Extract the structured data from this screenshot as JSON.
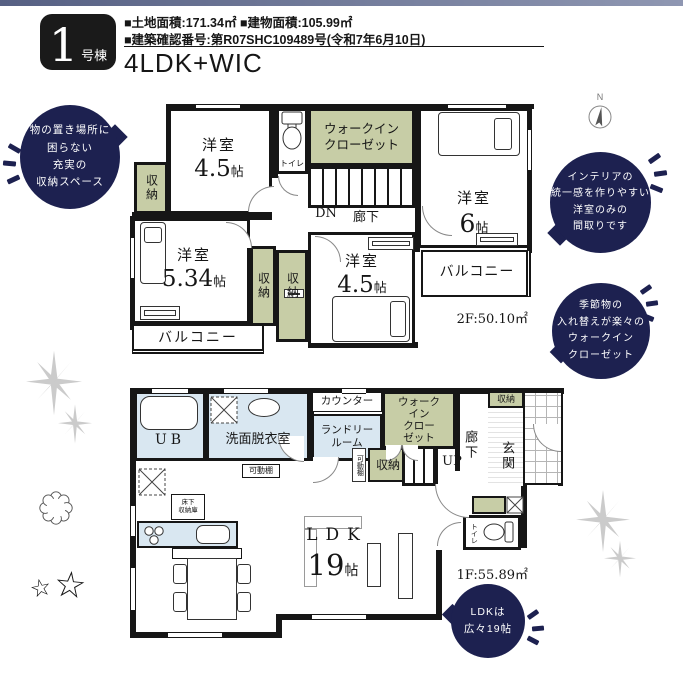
{
  "header": {
    "badge_number": "1",
    "badge_suffix": "号棟",
    "area_line": "■土地面積:171.34㎡ ■建物面積:105.99㎡",
    "permit_line": "■建築確認番号:第R07SHC109489号(令和7年6月10日)",
    "plan_type": "4LDK+WIC"
  },
  "compass": {
    "north": "N"
  },
  "callouts": {
    "storage": {
      "lines": [
        "物の置き場所に",
        "困らない",
        "充実の",
        "収納スペース"
      ]
    },
    "interior": {
      "lines": [
        "インテリアの",
        "統一感を作りやすい",
        "洋室のみの",
        "間取りです"
      ]
    },
    "wic": {
      "lines": [
        "季節物の",
        "入れ替えが楽々の",
        "ウォークイン",
        "クローゼット"
      ]
    },
    "ldk": {
      "lines": [
        "LDKは",
        "広々19帖"
      ]
    }
  },
  "labels": {
    "closet": "収納",
    "balcony": "バルコニー",
    "toilet": "トイレ",
    "hallway": "廊下",
    "shelf": "可動棚"
  },
  "floor2": {
    "area": "2F:50.10㎡",
    "dn": "DN",
    "wic_line1": "ウォークイン",
    "wic_line2": "クローゼット",
    "rooms": {
      "west": {
        "name": "洋室",
        "size": "4.5",
        "unit": "帖"
      },
      "east": {
        "name": "洋室",
        "size": "6",
        "unit": "帖"
      },
      "southwest": {
        "name": "洋室",
        "size": "5.34",
        "unit": "帖"
      },
      "south": {
        "name": "洋室",
        "size": "4.5",
        "unit": "帖"
      }
    }
  },
  "floor1": {
    "area": "1F:55.89㎡",
    "up": "UP",
    "ub": "UB",
    "washroom": "洗面脱衣室",
    "counter": "カウンター",
    "laundry_line1": "ランドリー",
    "laundry_line2": "ルーム",
    "wic_lines": [
      "ウォーク",
      "イン",
      "クロー",
      "ゼット"
    ],
    "entrance": "玄関",
    "underfloor_line1": "床下",
    "underfloor_line2": "収納庫",
    "ldk": {
      "name": "LDK",
      "size": "19",
      "unit": "帖"
    }
  },
  "icons": {
    "star": "☆"
  },
  "colors": {
    "navy": "#1d2150",
    "closet_green": "#c7cda6",
    "wet_blue": "#d9e7f1",
    "wall": "#161616",
    "topbar_left": "#566083",
    "topbar_right": "#8f97b2",
    "sparkle_gray": "#cbcbcb"
  }
}
